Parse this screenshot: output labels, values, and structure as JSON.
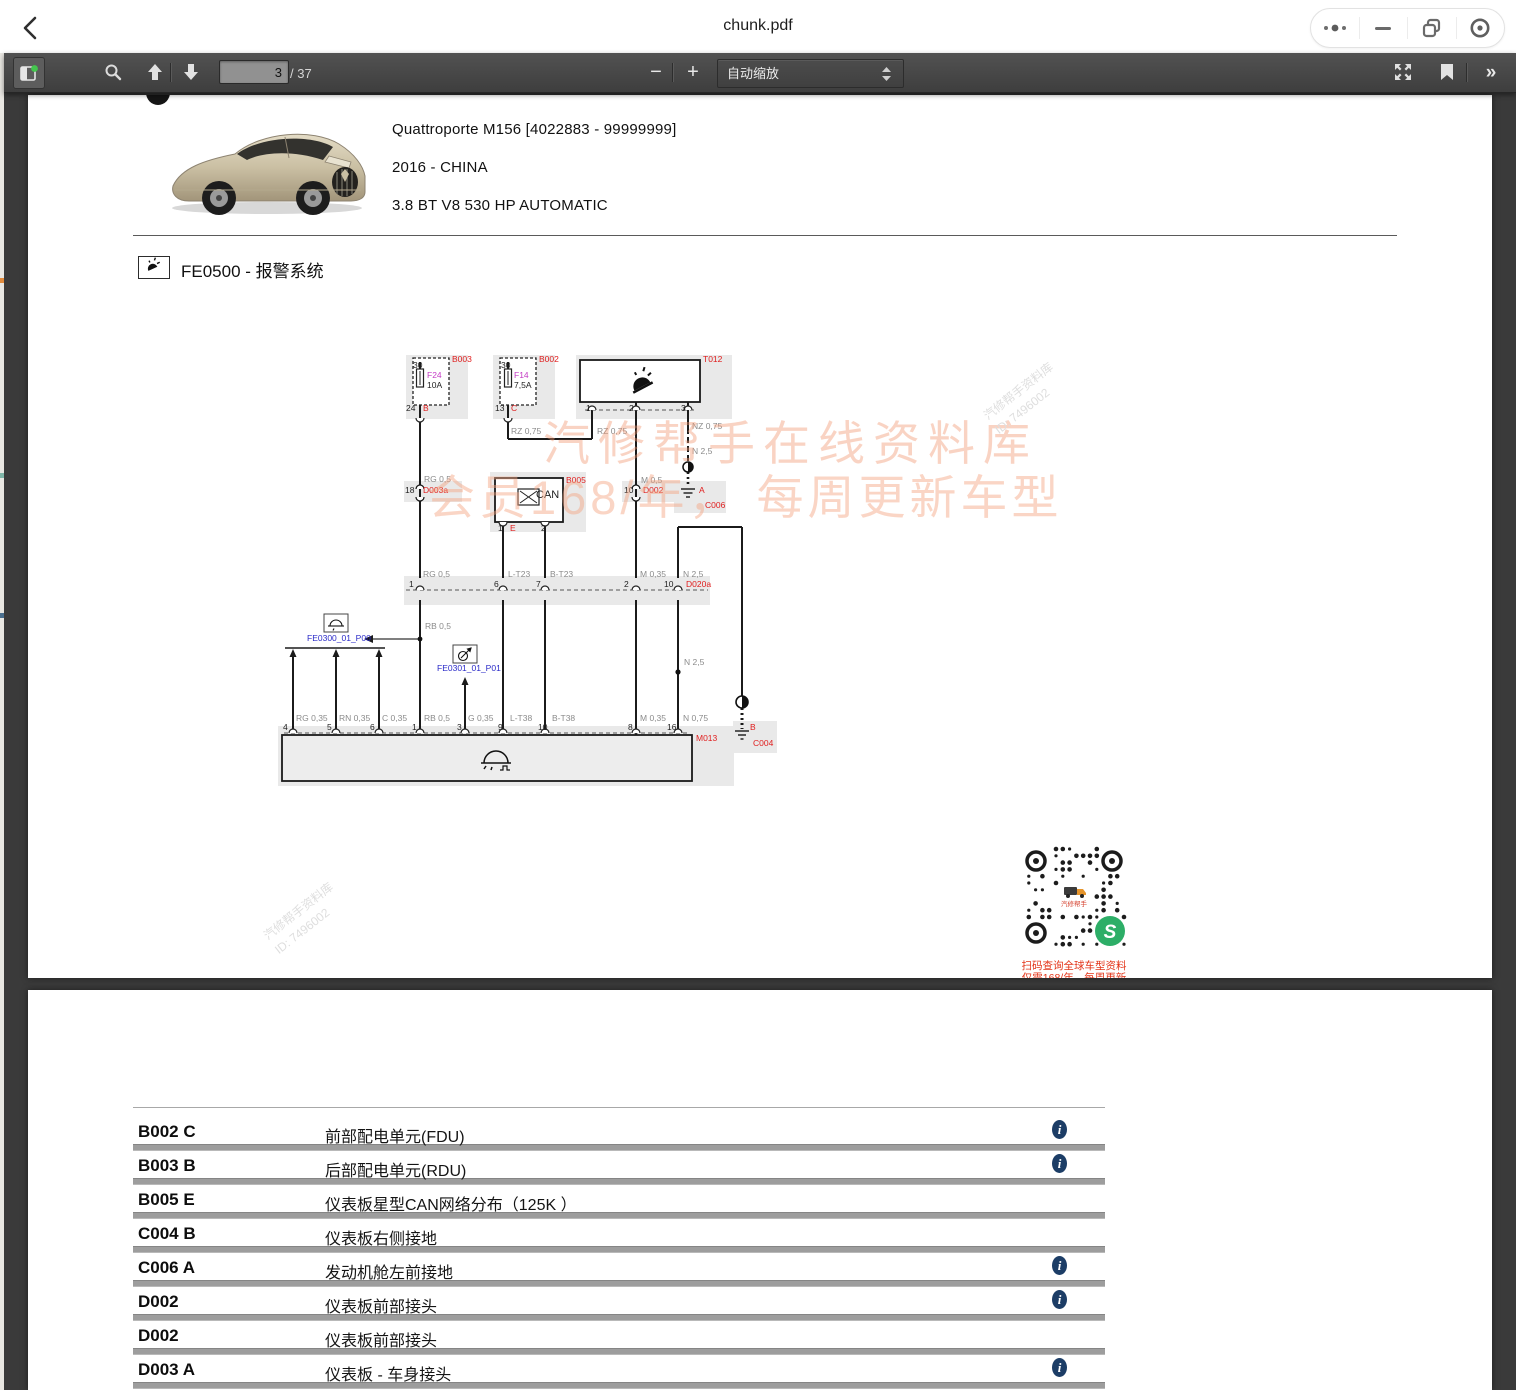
{
  "window": {
    "title": "chunk.pdf",
    "controls": [
      "more-options",
      "minimize",
      "restore",
      "record"
    ]
  },
  "toolbar": {
    "page_current": "3",
    "page_total": "/ 37",
    "zoom_label": "自动缩放",
    "zoom_out": "−",
    "zoom_in": "+",
    "more": "»"
  },
  "vehicle": {
    "model": "Quattroporte M156 [4022883 - 99999999]",
    "year_market": "2016 - CHINA",
    "engine": "3.8 BT V8 530 HP AUTOMATIC"
  },
  "section": {
    "title": "FE0500 - 报警系统"
  },
  "watermark": {
    "line1": "汽修帮手在线资料库",
    "line2": "会员168/年， 每周更新车型",
    "corner_text": "汽修帮手资料库",
    "corner_id": "ID: 7496002",
    "qr_logo_text": "汽修帮手",
    "qr_caption1": "扫码查询全球车型资料",
    "qr_caption2": "仅需168/年，每周更新"
  },
  "diagram": {
    "labels": [
      {
        "t": "B003",
        "x": 452,
        "y": 355,
        "c": "red"
      },
      {
        "t": "30",
        "x": 413,
        "y": 361,
        "c": "blk"
      },
      {
        "t": "F24",
        "x": 427,
        "y": 371,
        "c": "mag"
      },
      {
        "t": "10A",
        "x": 427,
        "y": 381,
        "c": "blk"
      },
      {
        "t": "24",
        "x": 406,
        "y": 404,
        "c": "blk"
      },
      {
        "t": "B",
        "x": 423,
        "y": 404,
        "c": "red"
      },
      {
        "t": "B002",
        "x": 539,
        "y": 355,
        "c": "red"
      },
      {
        "t": "30",
        "x": 501,
        "y": 361,
        "c": "blk"
      },
      {
        "t": "F14",
        "x": 514,
        "y": 371,
        "c": "mag"
      },
      {
        "t": "7,5A",
        "x": 514,
        "y": 381,
        "c": "blk"
      },
      {
        "t": "13",
        "x": 495,
        "y": 404,
        "c": "blk"
      },
      {
        "t": "C",
        "x": 511,
        "y": 404,
        "c": "red"
      },
      {
        "t": "T012",
        "x": 703,
        "y": 355,
        "c": "red"
      },
      {
        "t": "1",
        "x": 586,
        "y": 404,
        "c": "blk"
      },
      {
        "t": "2",
        "x": 629,
        "y": 404,
        "c": "blk"
      },
      {
        "t": "3",
        "x": 681,
        "y": 404,
        "c": "blk"
      },
      {
        "t": "RZ 0,75",
        "x": 511,
        "y": 427,
        "c": "gry"
      },
      {
        "t": "RZ 0,75",
        "x": 597,
        "y": 427,
        "c": "gry"
      },
      {
        "t": "NZ 0,75",
        "x": 692,
        "y": 422,
        "c": "gry"
      },
      {
        "t": "N 2,5",
        "x": 692,
        "y": 447,
        "c": "gry"
      },
      {
        "t": "RG 0,5",
        "x": 424,
        "y": 475,
        "c": "gry"
      },
      {
        "t": "18",
        "x": 405,
        "y": 486,
        "c": "blk"
      },
      {
        "t": "D003a",
        "x": 423,
        "y": 486,
        "c": "red"
      },
      {
        "t": "B005",
        "x": 566,
        "y": 476,
        "c": "red"
      },
      {
        "t": "CAN",
        "x": 536,
        "y": 490,
        "c": "blk",
        "s": 11
      },
      {
        "t": "1",
        "x": 498,
        "y": 524,
        "c": "blk"
      },
      {
        "t": "E",
        "x": 510,
        "y": 524,
        "c": "red"
      },
      {
        "t": "2",
        "x": 541,
        "y": 524,
        "c": "blk"
      },
      {
        "t": "M 0,5",
        "x": 641,
        "y": 476,
        "c": "gry"
      },
      {
        "t": "10",
        "x": 624,
        "y": 486,
        "c": "blk"
      },
      {
        "t": "D002",
        "x": 643,
        "y": 486,
        "c": "red"
      },
      {
        "t": "A",
        "x": 699,
        "y": 486,
        "c": "red"
      },
      {
        "t": "C006",
        "x": 705,
        "y": 501,
        "c": "red"
      },
      {
        "t": "RG 0,5",
        "x": 423,
        "y": 570,
        "c": "gry"
      },
      {
        "t": "L-T23",
        "x": 508,
        "y": 570,
        "c": "gry"
      },
      {
        "t": "B-T23",
        "x": 550,
        "y": 570,
        "c": "gry"
      },
      {
        "t": "M 0,35",
        "x": 640,
        "y": 570,
        "c": "gry"
      },
      {
        "t": "N 2,5",
        "x": 683,
        "y": 570,
        "c": "gry"
      },
      {
        "t": "1",
        "x": 409,
        "y": 580,
        "c": "blk"
      },
      {
        "t": "6",
        "x": 494,
        "y": 580,
        "c": "blk"
      },
      {
        "t": "7",
        "x": 536,
        "y": 580,
        "c": "blk"
      },
      {
        "t": "2",
        "x": 624,
        "y": 580,
        "c": "blk"
      },
      {
        "t": "10",
        "x": 664,
        "y": 580,
        "c": "blk"
      },
      {
        "t": "D020a",
        "x": 686,
        "y": 580,
        "c": "red"
      },
      {
        "t": "RB 0,5",
        "x": 425,
        "y": 622,
        "c": "gry"
      },
      {
        "t": "FE0300_01_P00",
        "x": 307,
        "y": 634,
        "c": "blu"
      },
      {
        "t": "FE0301_01_P01",
        "x": 437,
        "y": 664,
        "c": "blu"
      },
      {
        "t": "N 2,5",
        "x": 684,
        "y": 658,
        "c": "gry"
      },
      {
        "t": "RG 0,35",
        "x": 296,
        "y": 714,
        "c": "gry"
      },
      {
        "t": "RN 0,35",
        "x": 339,
        "y": 714,
        "c": "gry"
      },
      {
        "t": "C 0,35",
        "x": 382,
        "y": 714,
        "c": "gry"
      },
      {
        "t": "RB 0,5",
        "x": 424,
        "y": 714,
        "c": "gry"
      },
      {
        "t": "G 0,35",
        "x": 468,
        "y": 714,
        "c": "gry"
      },
      {
        "t": "L-T38",
        "x": 510,
        "y": 714,
        "c": "gry"
      },
      {
        "t": "B-T38",
        "x": 552,
        "y": 714,
        "c": "gry"
      },
      {
        "t": "M 0,35",
        "x": 640,
        "y": 714,
        "c": "gry"
      },
      {
        "t": "N 0,75",
        "x": 683,
        "y": 714,
        "c": "gry"
      },
      {
        "t": "4",
        "x": 283,
        "y": 723,
        "c": "blk"
      },
      {
        "t": "5",
        "x": 327,
        "y": 723,
        "c": "blk"
      },
      {
        "t": "6",
        "x": 370,
        "y": 723,
        "c": "blk"
      },
      {
        "t": "1",
        "x": 412,
        "y": 723,
        "c": "blk"
      },
      {
        "t": "3",
        "x": 457,
        "y": 723,
        "c": "blk"
      },
      {
        "t": "9",
        "x": 498,
        "y": 723,
        "c": "blk"
      },
      {
        "t": "10",
        "x": 538,
        "y": 723,
        "c": "blk"
      },
      {
        "t": "8",
        "x": 628,
        "y": 723,
        "c": "blk"
      },
      {
        "t": "16",
        "x": 667,
        "y": 723,
        "c": "blk"
      },
      {
        "t": "M013",
        "x": 696,
        "y": 734,
        "c": "red"
      },
      {
        "t": "B",
        "x": 750,
        "y": 723,
        "c": "red"
      },
      {
        "t": "C004",
        "x": 753,
        "y": 739,
        "c": "red"
      }
    ]
  },
  "table": {
    "info_glyph": "i",
    "rows": [
      {
        "code": "B002 C",
        "desc": "前部配电单元(FDU)",
        "info": true
      },
      {
        "code": "B003 B",
        "desc": "后部配电单元(RDU)",
        "info": true
      },
      {
        "code": "B005 E",
        "desc": "仪表板星型CAN网络分布（125K ）",
        "info": false
      },
      {
        "code": "C004 B",
        "desc": "仪表板右侧接地",
        "info": false
      },
      {
        "code": "C006 A",
        "desc": "发动机舱左前接地",
        "info": true
      },
      {
        "code": "D002",
        "desc": "仪表板前部接头",
        "info": true
      },
      {
        "code": "D002",
        "desc": "仪表板前部接头",
        "info": false
      },
      {
        "code": "D003 A",
        "desc": "仪表板 - 车身接头",
        "info": true
      }
    ]
  }
}
